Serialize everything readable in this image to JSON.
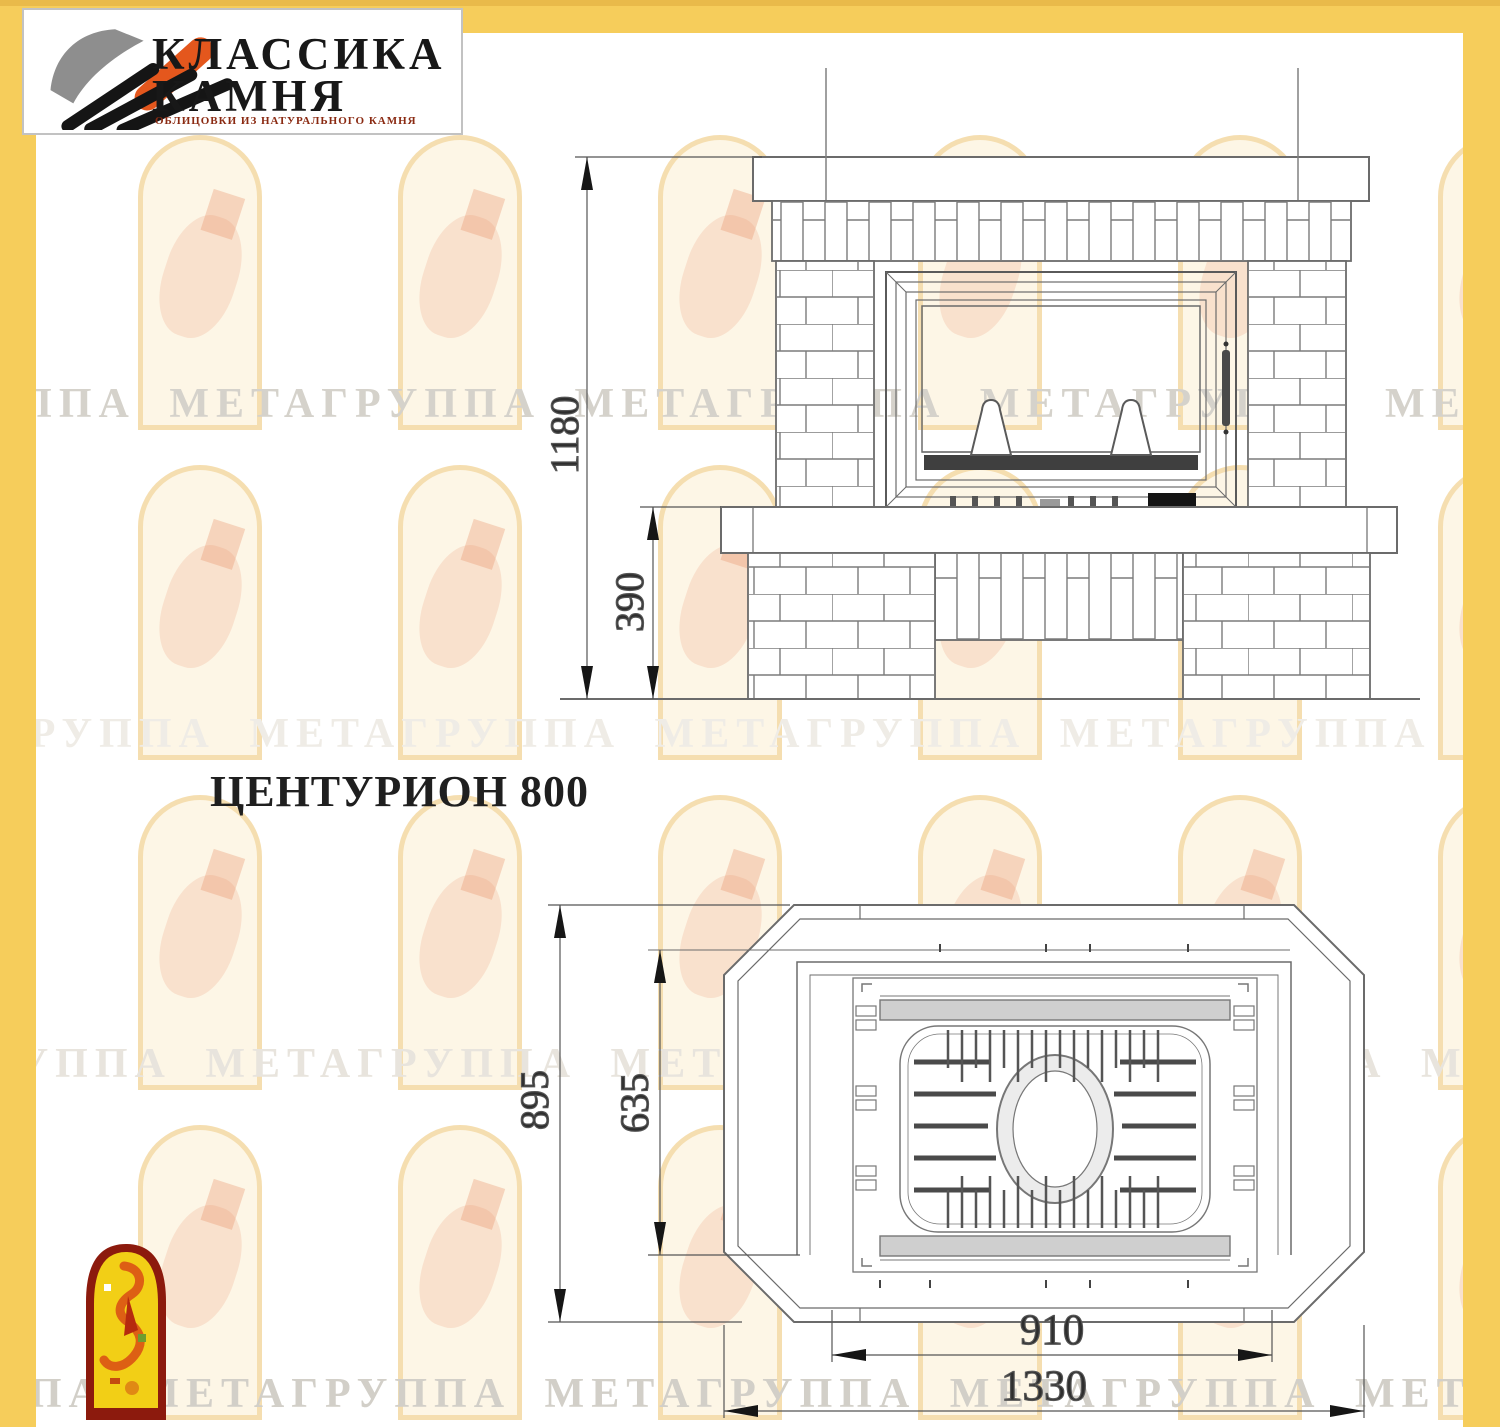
{
  "logo": {
    "line1": "КЛАССИКА",
    "line2": "КАМНЯ",
    "subtitle": "ОБЛИЦОВКИ ИЗ НАТУРАЛЬНОГО КАМНЯ"
  },
  "drawing": {
    "title": "ЦЕНТУРИОН 800",
    "front_view": {
      "dim_total_height": "1180",
      "dim_base_height": "390"
    },
    "plan_view": {
      "dim_depth_total": "895",
      "dim_depth_firebox": "635",
      "dim_width_firebox": "910",
      "dim_width_total": "1330"
    }
  },
  "watermark": {
    "text": "ГРУППА МЕТАГРУППА МЕТАГРУППА МЕТАГРУППА МЕТАГРУППА МЕТАГРУППА МЕТА"
  },
  "colors": {
    "border_yellow": "#f6cd5b",
    "logo_orange": "#e4571d",
    "mascot_red": "#8c1a0d",
    "mascot_yellow": "#f2cf16"
  }
}
